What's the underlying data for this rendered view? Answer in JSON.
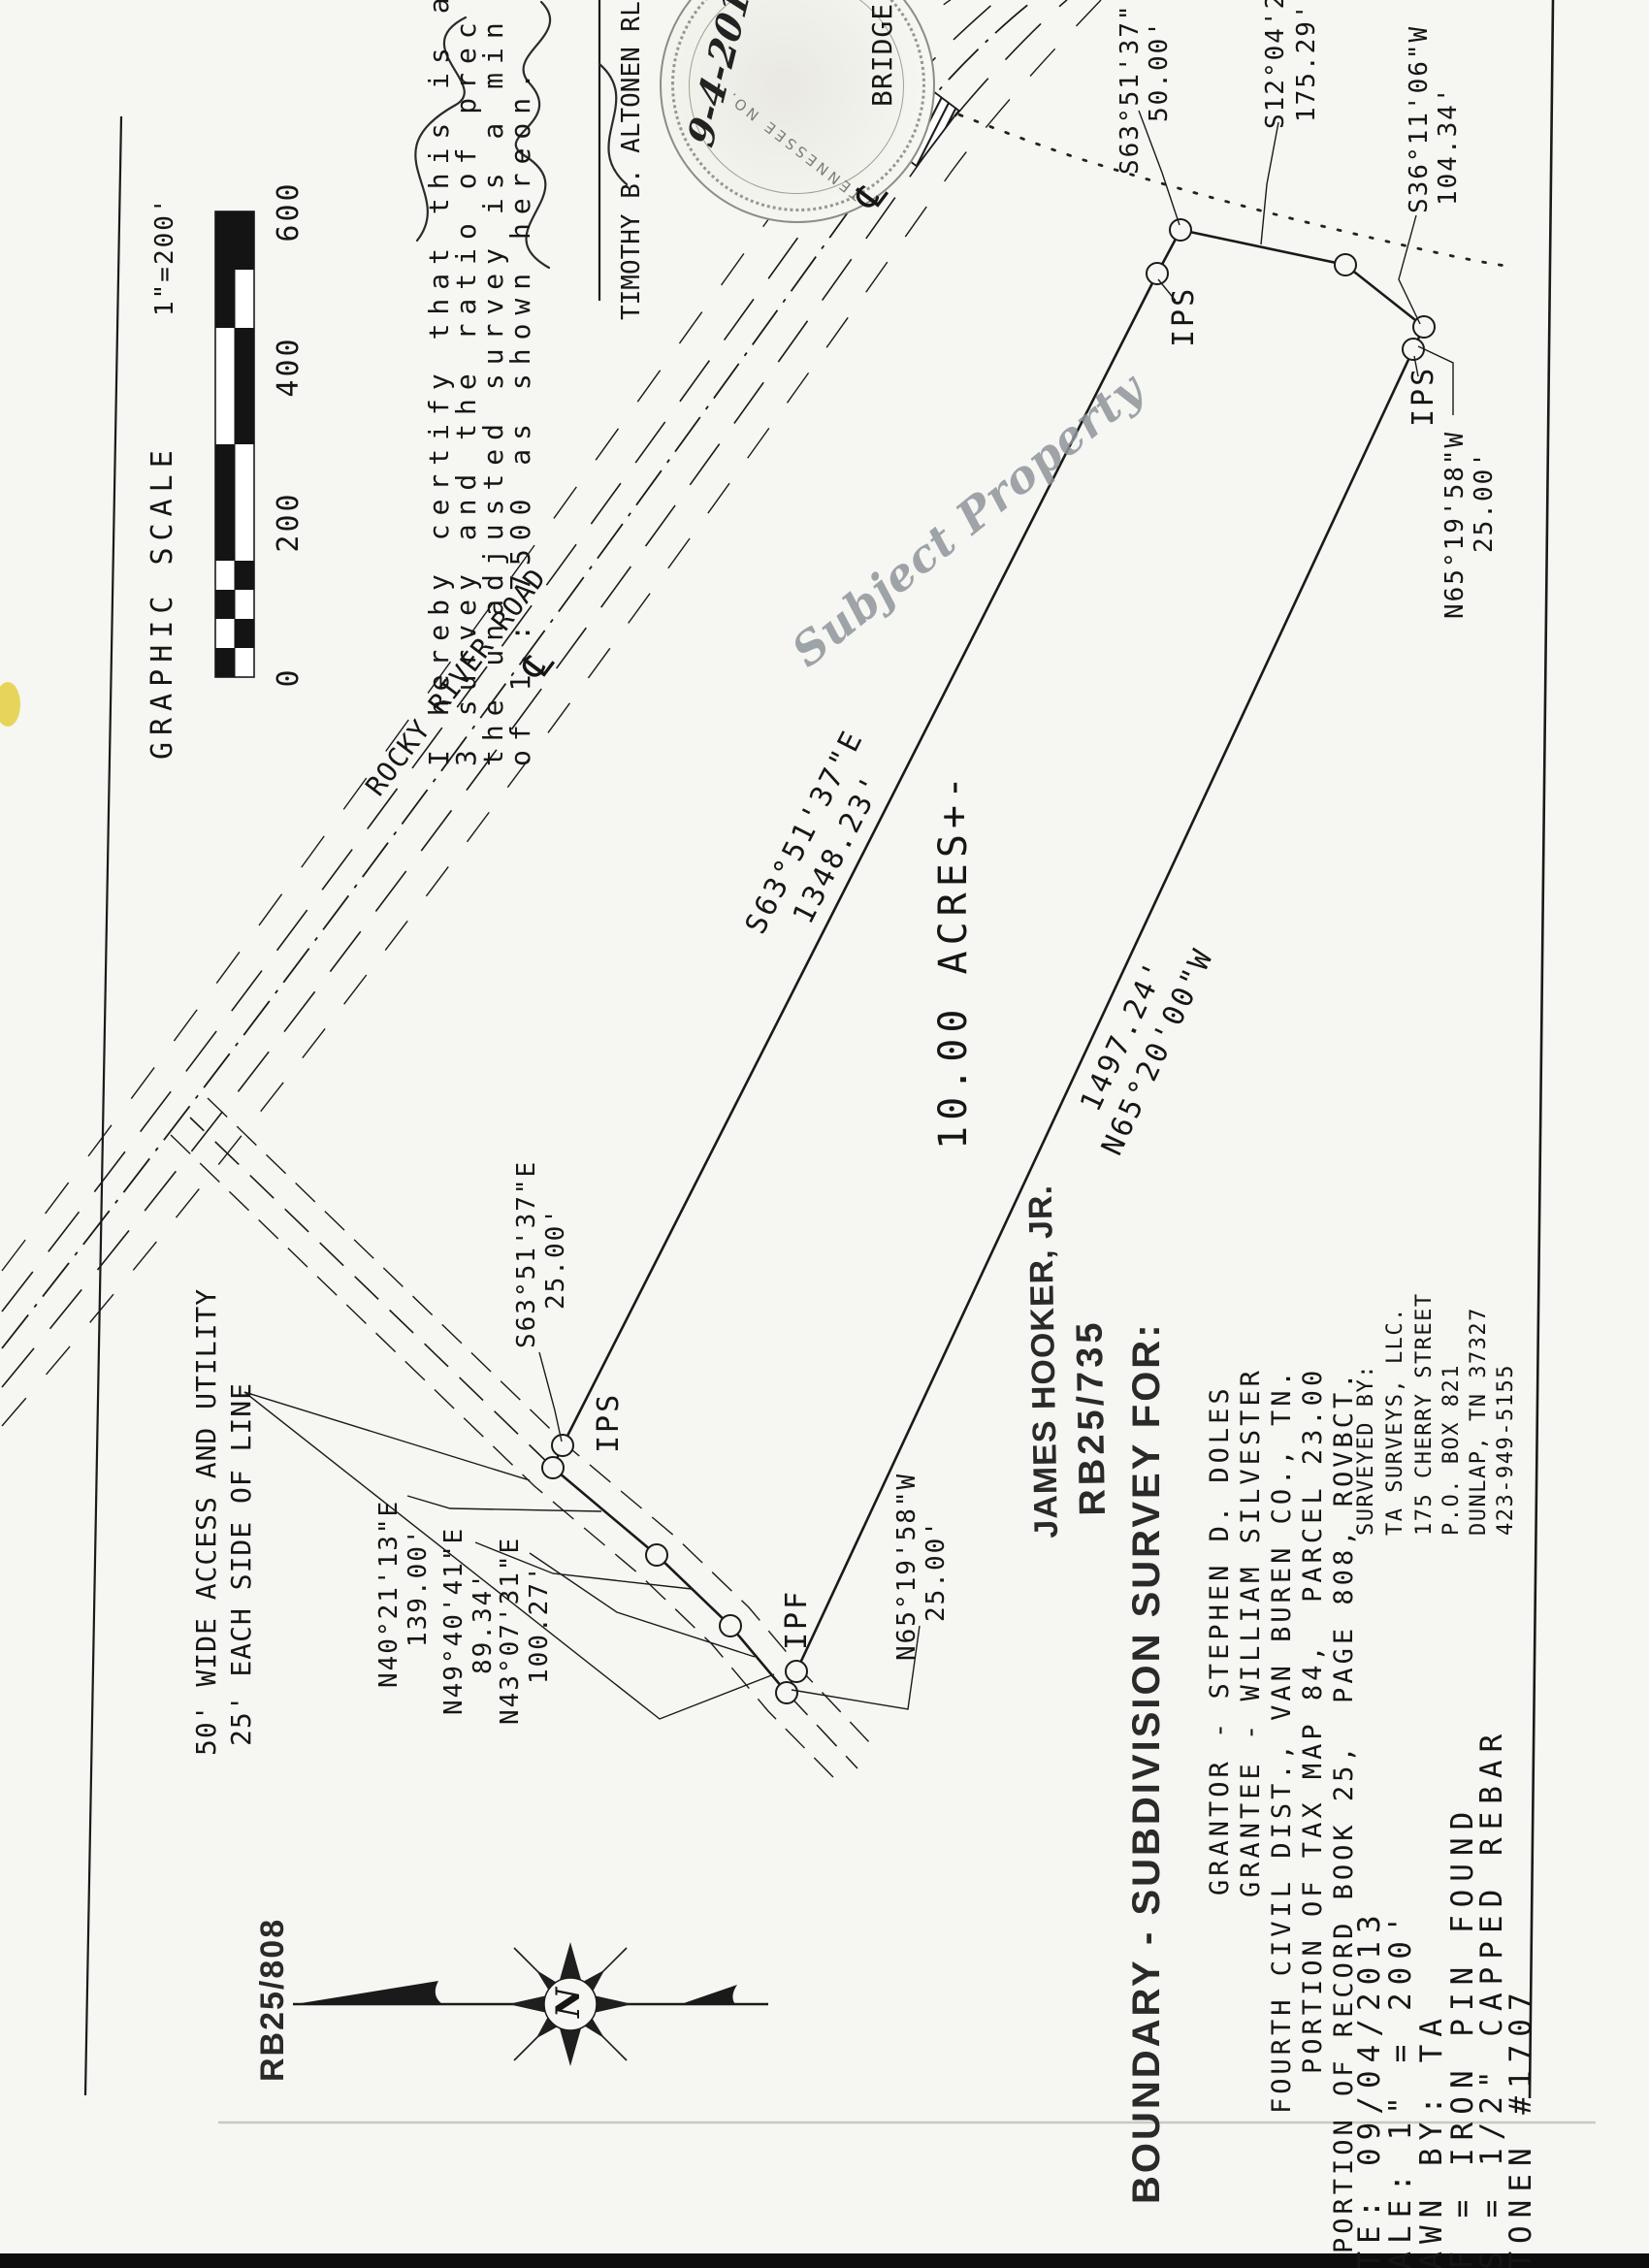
{
  "scale_block": {
    "title": "GRAPHIC SCALE",
    "ratio": "1\"=200'",
    "ticks": [
      "0",
      "200",
      "400",
      "600"
    ]
  },
  "certification": {
    "line1": "I hereby certify that this is a",
    "line2": "3 survey and the ratio of prec",
    "line3": "the unadjusted survey is a min",
    "line4": "of 1 : 7500 as shown hereon."
  },
  "surveyor": {
    "name": "TIMOTHY B. ALTONEN RLS",
    "handwritten_date": "9-4-2013",
    "seal_text": "TENNESSEE NO."
  },
  "road": {
    "name": "ROCKY RIVER ROAD",
    "bridge": "BRIDGE",
    "centerline_symbol": "℄"
  },
  "watermark": {
    "text": "Subject Property"
  },
  "parcel": {
    "area": "10.00 ACRES+-",
    "north_line": {
      "bearing": "S63°51'37\"E",
      "distance": "1348.23'"
    },
    "south_line": {
      "distance": "1497.24'",
      "bearing": "N65°20'00\"W"
    },
    "ne1": {
      "bearing": "S63°51'37\"",
      "distance": "50.00'"
    },
    "ne2": {
      "bearing": "S12°04'28\"",
      "distance": "175.29'"
    },
    "ne3": {
      "bearing": "S36°11'06\"W",
      "distance": "104.34'"
    },
    "se25": {
      "bearing": "N65°19'58\"W",
      "distance": "25.00'"
    },
    "w25": {
      "bearing": "S63°51'37\"E",
      "distance": "25.00'"
    },
    "sw25": {
      "bearing": "N65°19'58\"W",
      "distance": "25.00'"
    },
    "markers": {
      "ips": "IPS",
      "ipf": "IPF"
    }
  },
  "access": {
    "label1": "50' WIDE ACCESS AND UTILITY",
    "label2": "25' EACH SIDE OF LINE",
    "seg1": {
      "bearing": "N40°21'13\"E",
      "distance": "139.00'"
    },
    "seg2": {
      "bearing": "N49°40'41\"E",
      "distance": "89.34'"
    },
    "seg3": {
      "bearing": "N43°07'31\"E",
      "distance": "100.27'"
    }
  },
  "adjoiner": {
    "name": "JAMES HOOKER, JR.",
    "book": "RB25/735"
  },
  "rb808": {
    "text": "RB25/808"
  },
  "title_block": {
    "line1": "BOUNDARY - SUBDIVISION SURVEY FOR:",
    "line2": "GRANTOR - STEPHEN D. DOLES",
    "line3": "GRANTEE - WILLIAM SILVESTER",
    "line4": "FOURTH CIVIL DIST., VAN BUREN CO., TN.",
    "line5": "PORTION OF TAX MAP 84,  PARCEL 23.00",
    "line6": "PORTION OF RECORD BOOK 25,  PAGE 808, ROVBCT."
  },
  "surveyed_by": {
    "line1": "SURVEYED BY:",
    "line2": "TA SURVEYS, LLC.",
    "line3": "175 CHERRY STREET",
    "line4": "P.O. BOX 821",
    "line5": "DUNLAP, TN 37327",
    "line6": "423-949-5155"
  },
  "notes": {
    "line1": "DATE: 09/04/2013",
    "line2": "SCALE: 1\" = 200'",
    "line3": "DRAWN BY: TA",
    "line4": "IPF = IRON PIN FOUND",
    "line5": "IPS = 1/2\" CAPPED REBAR",
    "line6": "ALTONEN #1707"
  },
  "compass": {
    "north": "N"
  }
}
